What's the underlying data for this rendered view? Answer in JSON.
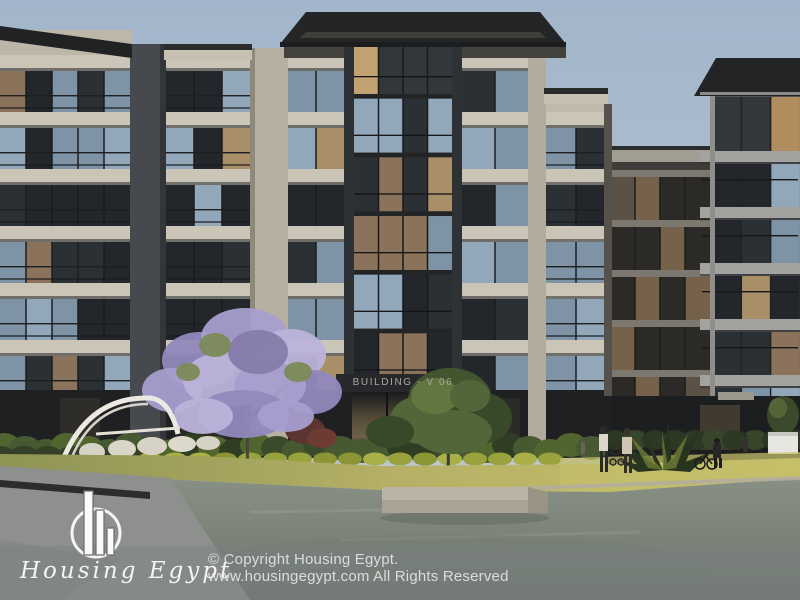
{
  "watermark": {
    "line1": "© Copyright Housing Egypt.",
    "line2": "www.housingegypt.com All Rights Reserved"
  },
  "logo": {
    "brand": "Housing Egypt",
    "icon": "skyline-bars-circle-icon"
  },
  "scene": {
    "building_sign": "BUILDING - V 06"
  },
  "colors": {
    "sky_top": "#a2b5ca",
    "sky_bottom": "#c3ccd6",
    "concrete": "#c2bcae",
    "pier_dark": "#44474b",
    "glass_dark": "#23272b",
    "glass_reflection": "#8fa4b6",
    "glass_warm": "#a98f68",
    "roof": "#232527",
    "lawn": "#b5b065",
    "hedge": "#3a4b2b",
    "jacaranda": "#a79ecf",
    "tree_green": "#42552f",
    "water": "#8a9288",
    "pavement": "#8e908d",
    "watermark_band": "rgba(125,128,131,0.42)",
    "watermark_text": "#e4e4e4",
    "brand_white": "#f5f4f1"
  }
}
